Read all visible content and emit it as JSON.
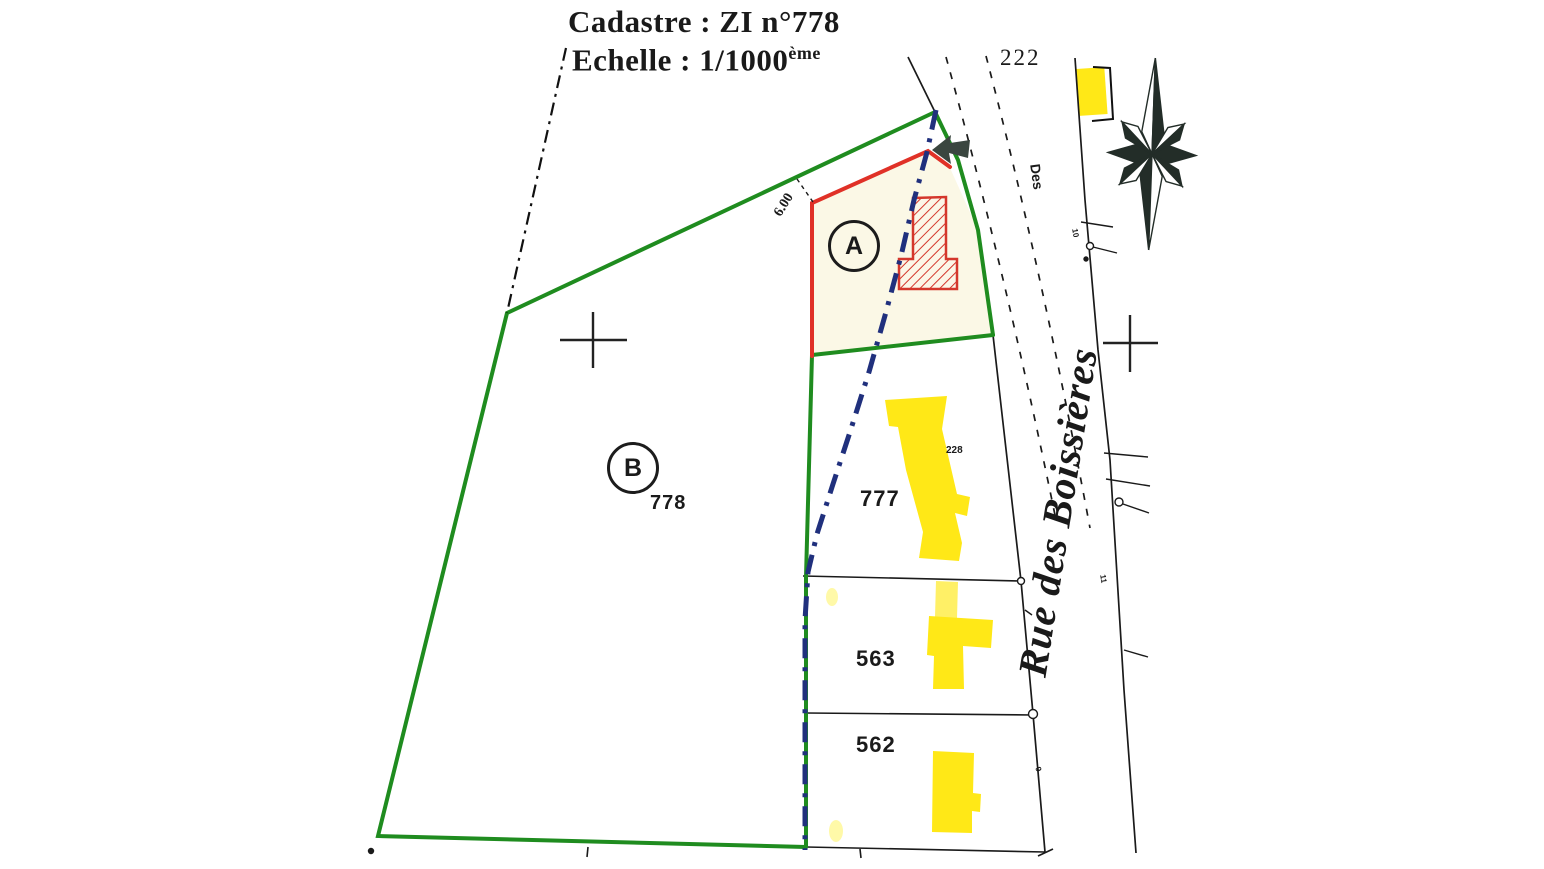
{
  "document": {
    "title": "Cadastre : ZI n°778",
    "scale_label": "Echelle : 1/1000",
    "scale_exponent": "ème"
  },
  "street": {
    "name": "Rue des Boissières",
    "partial_label": "Des"
  },
  "zones": {
    "a": "A",
    "b": "B"
  },
  "parcels": {
    "p222": "222",
    "p778": "778",
    "p777": "777",
    "p563": "563",
    "p562": "562"
  },
  "annotations": {
    "building_number": "228",
    "dimension": "6.00",
    "house_numbers": [
      "10",
      "11",
      "9"
    ]
  },
  "colors": {
    "boundary_green": "#1f8c1f",
    "boundary_red": "#e03127",
    "axis_blue": "#20307d",
    "building_yellow": "#ffe817",
    "building_pale_yellow": "#fff9a8",
    "hatch_red": "#d4372c",
    "parcel_a_fill": "#fbf8e6",
    "ink_black": "#1a1a1a"
  }
}
